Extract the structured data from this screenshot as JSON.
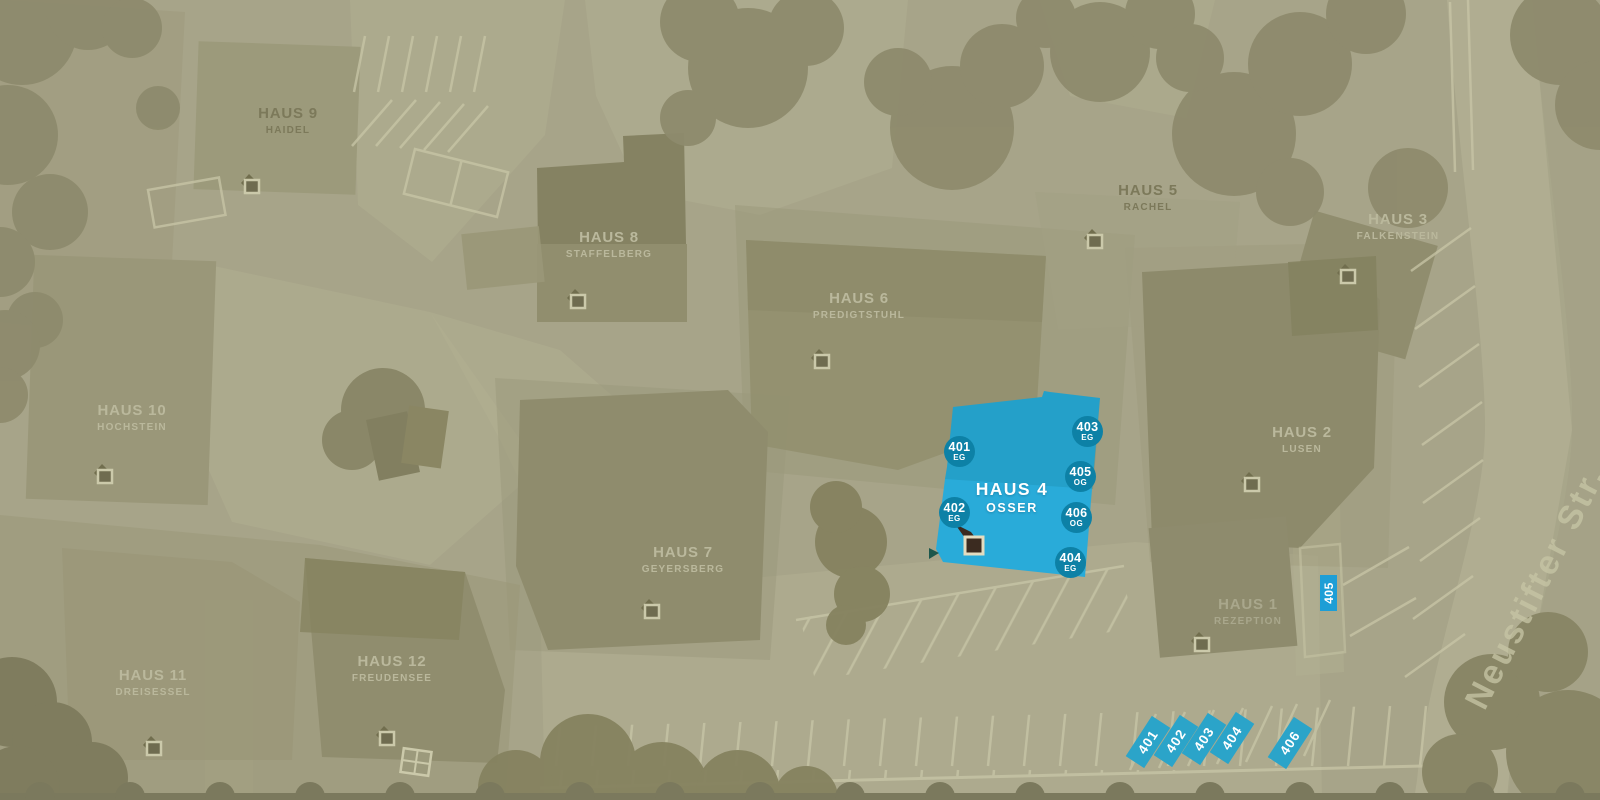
{
  "map": {
    "street": {
      "name": "Neustifter Str."
    },
    "colors": {
      "background": "#a7a489",
      "highlight_blue": "#29abd9",
      "badge_blue": "#0d81a6",
      "stall_blue": "#2ba4c9"
    },
    "houses": [
      {
        "name": "HAUS 9",
        "subtitle": "HAIDEL"
      },
      {
        "name": "HAUS 8",
        "subtitle": "STAFFELBERG"
      },
      {
        "name": "HAUS 5",
        "subtitle": "RACHEL"
      },
      {
        "name": "HAUS 3",
        "subtitle": "FALKENSTEIN"
      },
      {
        "name": "HAUS 6",
        "subtitle": "PREDIGTSTUHL"
      },
      {
        "name": "HAUS 10",
        "subtitle": "HOCHSTEIN"
      },
      {
        "name": "HAUS 2",
        "subtitle": "LUSEN"
      },
      {
        "name": "HAUS 7",
        "subtitle": "GEYERSBERG"
      },
      {
        "name": "HAUS 4",
        "subtitle": "OSSER",
        "highlighted": true
      },
      {
        "name": "HAUS 1",
        "subtitle": "REZEPTION"
      },
      {
        "name": "HAUS 11",
        "subtitle": "DREISESSEL"
      },
      {
        "name": "HAUS 12",
        "subtitle": "FREUDENSEE"
      }
    ],
    "rooms": [
      {
        "number": "401",
        "floor": "EG"
      },
      {
        "number": "402",
        "floor": "EG"
      },
      {
        "number": "403",
        "floor": "EG"
      },
      {
        "number": "404",
        "floor": "EG"
      },
      {
        "number": "405",
        "floor": "OG"
      },
      {
        "number": "406",
        "floor": "OG"
      }
    ],
    "parking_spots": [
      "401",
      "402",
      "403",
      "404",
      "405",
      "406"
    ]
  }
}
